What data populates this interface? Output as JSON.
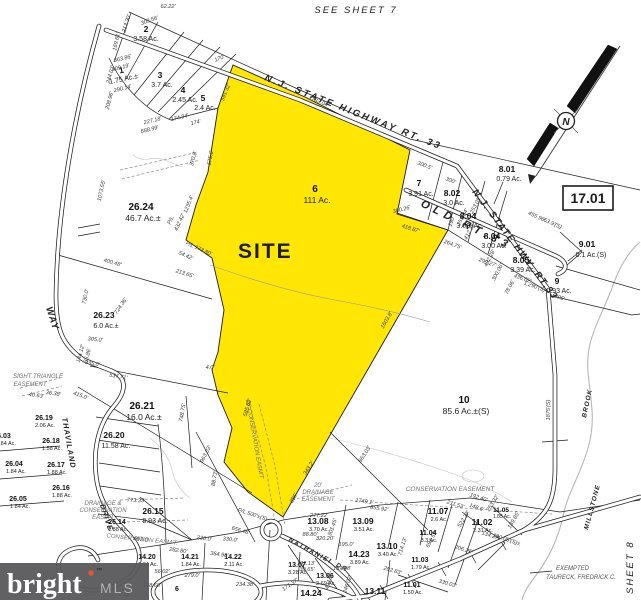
{
  "header": {
    "sheet_top": "SEE SHEET 7",
    "sheet_right": "SEE SHEET 8"
  },
  "site": {
    "label": "SITE",
    "color": "#ffe604",
    "label_color": "#cc2418"
  },
  "inset_box": {
    "label": "17.01"
  },
  "north_arrow": {
    "label": "N"
  },
  "roads": {
    "hwy33_upper": "N.J.  STATE  HIGHWAY  RT.  33",
    "hwy33_lower": "N.J. STATE HWY. RT.33",
    "old_rt33": "OLD RT.33",
    "way": "WAY",
    "thaviland": "THAVILAND",
    "thaviland2": "DRIVE",
    "nathaniel": "NATHANIEL DR"
  },
  "water": {
    "millstone": "MILLSTONE",
    "brook": "BROOK"
  },
  "notes": {
    "exempted1": "EXEMPTED",
    "exempted2": "TAURECK, FREDRICK C."
  },
  "easements": {
    "sight1": "SIGHT TRIANGLE",
    "sight2": "EASEMENT",
    "cons25": "25' CONSERVATION EASM'T",
    "drain_cons1": "DRAINAGE &",
    "drain_cons2": "CONSERVATION",
    "drain_cons3": "EASM'T",
    "drain20_1": "20'",
    "drain20_2": "DRAINAGE",
    "drain20_3": "EASEMENT",
    "conservation": "CONSERVATION  EASEMENT",
    "cons_bottom": "CONSERVATION  EASM'T."
  },
  "parcels": {
    "p1": {
      "lot": "1",
      "ac": "1.75 Ac.±"
    },
    "p2": {
      "lot": "2",
      "ac": "3.58 Ac."
    },
    "p3": {
      "lot": "3",
      "ac": "3.7 Ac."
    },
    "p4": {
      "lot": "4",
      "ac": "2.45 Ac."
    },
    "p5": {
      "lot": "5",
      "ac": "2.4 Ac."
    },
    "p6": {
      "lot": "6",
      "ac": "111 Ac."
    },
    "p7": {
      "lot": "7",
      "ac": "3.91 Ac."
    },
    "p8_01": {
      "lot": "8.01",
      "ac": "0.79 Ac."
    },
    "p8_02": {
      "lot": "8.02",
      "ac": "3.0 Ac."
    },
    "p8_04a": {
      "lot": "8.04",
      "ac": "3.00. Ac."
    },
    "p8_04b": {
      "lot": "8.04",
      "ac": "3.00 Ac."
    },
    "p8_05": {
      "lot": "8.05",
      "ac": "3.39 Ac."
    },
    "p9": {
      "lot": "9",
      "ac": "0.93 Ac."
    },
    "p9_01": {
      "lot": "9.01",
      "ac": "0.1 Ac.(S)"
    },
    "p10": {
      "lot": "10",
      "ac": "85.6 Ac.±(S)"
    },
    "p26_24": {
      "lot": "26.24",
      "ac": "46.7 Ac.±"
    },
    "p26_23": {
      "lot": "26.23",
      "ac": "6.0 Ac.±"
    },
    "p26_21": {
      "lot": "26.21",
      "ac": "16.0 Ac.±"
    },
    "p26_20": {
      "lot": "26.20",
      "ac": "11.58 Ac."
    },
    "p26_19": {
      "lot": "26.19",
      "ac": "2.06 Ac."
    },
    "p26_18": {
      "lot": "26.18",
      "ac": "1.58 Ac."
    },
    "p26_17": {
      "lot": "26.17",
      "ac": "1.88 Ac."
    },
    "p26_16": {
      "lot": "26.16",
      "ac": "1.88 Ac."
    },
    "p26_15": {
      "lot": "26.15",
      "ac": "8.93 Ac."
    },
    "p26_14": {
      "lot": "26.14",
      "ac": "1.88 Ac."
    },
    "p26_03": {
      "lot": "26.03",
      "ac": "1.84 Ac."
    },
    "p26_04": {
      "lot": "26.04",
      "ac": "1.84 Ac."
    },
    "p26_05": {
      "lot": "26.05",
      "ac": "1.84 Ac."
    },
    "p14_20": {
      "lot": "14.20",
      "ac": "1.84 Ac."
    },
    "p14_21": {
      "lot": "14.21",
      "ac": "1.84 Ac."
    },
    "p14_22": {
      "lot": "14.22",
      "ac": "2.11 Ac."
    },
    "p14_23": {
      "lot": "14.23",
      "ac": "3.89 Ac."
    },
    "p14_24": {
      "lot": "14.24",
      "ac": ""
    },
    "p13_06": {
      "lot": "13.06",
      "ac": "2.69 Ac."
    },
    "p13_07": {
      "lot": "13.07",
      "ac": "3.28 Ac."
    },
    "p13_08": {
      "lot": "13.08",
      "ac": "3.70 Ac."
    },
    "p13_09": {
      "lot": "13.09",
      "ac": "3.51 Ac."
    },
    "p13_10": {
      "lot": "13.10",
      "ac": "3.40 Ac."
    },
    "p13_11": {
      "lot": "13.11",
      "ac": ""
    },
    "p11_01": {
      "lot": "11.01",
      "ac": "1.50 Ac."
    },
    "p11_02": {
      "lot": "11.02",
      "ac": "2.31 Ac."
    },
    "p11_03": {
      "lot": "11.03",
      "ac": "1.79 Ac."
    },
    "p11_04": {
      "lot": "11.04",
      "ac": "3.3 Ac."
    },
    "p11_05": {
      "lot": "11.05",
      "ac": "1.85 Ac."
    },
    "p11_07": {
      "lot": "11.07",
      "ac": "2.6 Ac."
    },
    "pcul5": {
      "lot": "5",
      "ac": ""
    },
    "pcul6": {
      "lot": "6",
      "ac": ""
    }
  },
  "dims": [
    "62.22'",
    "303.56'",
    "213.30'",
    "169.61'",
    "363.86'",
    "309.19'",
    "244.02'",
    "290.14'",
    "208.96'",
    "227.18'",
    "888.99'",
    "174.94'",
    "174'",
    "170'",
    "1783.04'",
    "575.6'",
    "591.32'",
    "300.5'",
    "300'",
    "300.26'",
    "418.87'",
    "190'",
    "253.03'",
    "253.24'",
    "412.35'",
    "264.75'",
    "299.27'",
    "436.02'",
    "1,290'(S)",
    "432.28'",
    "300.06'",
    "78.06'",
    "455.96'",
    "63.9'(S)",
    "205'",
    "1875'(S)",
    "370.8'",
    "1073.55'",
    "1235.4'",
    "432.42'",
    "P/L",
    "P/L 173.80'",
    "54.42'",
    "213.65'",
    "400.48'",
    "724.36'",
    "730.0'",
    "4.0'",
    "585.82'",
    "88.73'",
    "1603.8'",
    "537.71'",
    "748.75'",
    "415.0'",
    "144.12'",
    "35.86'",
    "335.0'",
    "305.0'",
    "40.63'",
    "36.38'",
    "963.03'",
    "656.46'",
    "P/L 500'±(S)",
    "343.2'",
    "386'",
    "1749.1'",
    "855.92'",
    "773.33'",
    "693.0'",
    "282.80'",
    "364.98'",
    "230.0'",
    "148.60'",
    "234.38'",
    "279.0'",
    "56.02'",
    "171.37'",
    "330.0'",
    "320.20'",
    "195.0'",
    "301.45'",
    "277.22'",
    "88.80'",
    "192.13'",
    "39.65'",
    "157.08'",
    "404.96'",
    "246.02'",
    "202.83'",
    "330.03'",
    "714.13'",
    "692.53'",
    "211.53'",
    "148.6'",
    "192.40'",
    "253.32'",
    "522.37'",
    "189.85'",
    "134.27'",
    "190.05'(S)±",
    "206.27'",
    "963.03'"
  ],
  "watermark": {
    "brand": "bright",
    "tm": "™",
    "suffix": "MLS",
    "box_color": "#59595c",
    "dot_color": "#de5a2c"
  }
}
